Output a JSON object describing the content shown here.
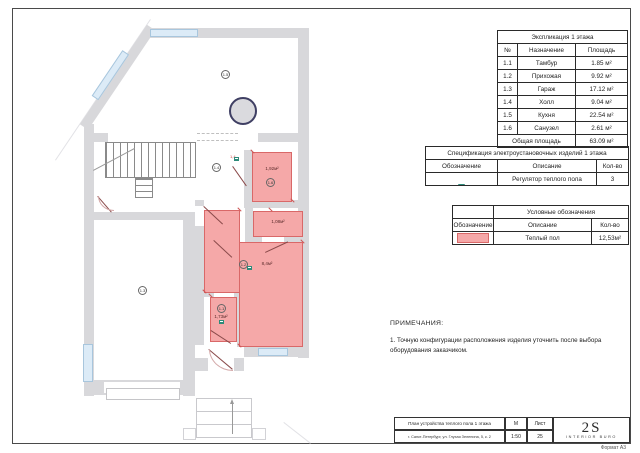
{
  "colors": {
    "warm_floor": "#f5a8a8",
    "wall_gray": "#d8d8db",
    "window_blue": "#dcebf7",
    "regulator_teal": "#2e8b7a"
  },
  "explication": {
    "title": "Экспликация 1 этажа",
    "headers": [
      "№",
      "Назначение",
      "Площадь"
    ],
    "rows": [
      [
        "1.1",
        "Тамбур",
        "1.85 м²"
      ],
      [
        "1.2",
        "Прихожая",
        "9.92 м²"
      ],
      [
        "1.3",
        "Гараж",
        "17.12 м²"
      ],
      [
        "1.4",
        "Холл",
        "9.04 м²"
      ],
      [
        "1.5",
        "Кухня",
        "22.54 м²"
      ],
      [
        "1.6",
        "Санузел",
        "2.61 м²"
      ]
    ],
    "total_label": "Общая площадь",
    "total_value": "63.09 м²"
  },
  "spec": {
    "title": "Спецификация электроустановочных изделий 1 этажа",
    "headers": [
      "Обозначение",
      "Описание",
      "Кол-во"
    ],
    "row": {
      "icon": "floor-heating-regulator-icon",
      "description": "Регулятор теплого пола",
      "qty": "3"
    }
  },
  "legend": {
    "title": "Условные обозначения",
    "headers": [
      "Обозначение",
      "Описание",
      "Кол-во"
    ],
    "row": {
      "swatch_color": "#f5a8a8",
      "description": "Теплый пол",
      "qty": "12,53м²"
    }
  },
  "notes": {
    "title": "ПРИМЕЧАНИЯ:",
    "items": [
      "1. Точную конфигурации расположения изделия уточнить после выбора оборудования заказчиком."
    ]
  },
  "plan": {
    "room_numbers": {
      "kitchen": "1.5",
      "hall": "1.4",
      "garage": "1.3",
      "entry_hall": "1.2",
      "tambour": "1.1",
      "bathroom": "1.6"
    },
    "warm_floor_areas": {
      "bathroom": "1,92м²",
      "storage": "1,08м²",
      "entry_hall": "8,4м²",
      "tambour": "1,73м²"
    },
    "dim_label": "1,4"
  },
  "title_block": {
    "doc_title": "План устройства теплого пола 1 этажа",
    "address": "г. Санкт-Петербург, ул. Глухая Зеленина, 5, к. 2",
    "scale_header": "М",
    "scale_value": "1:50",
    "sheet_header": "Лист",
    "sheet_value": "25",
    "logo_text": "2S",
    "logo_sub": "INTERIOR BURO"
  },
  "format_label": "Формат А3"
}
